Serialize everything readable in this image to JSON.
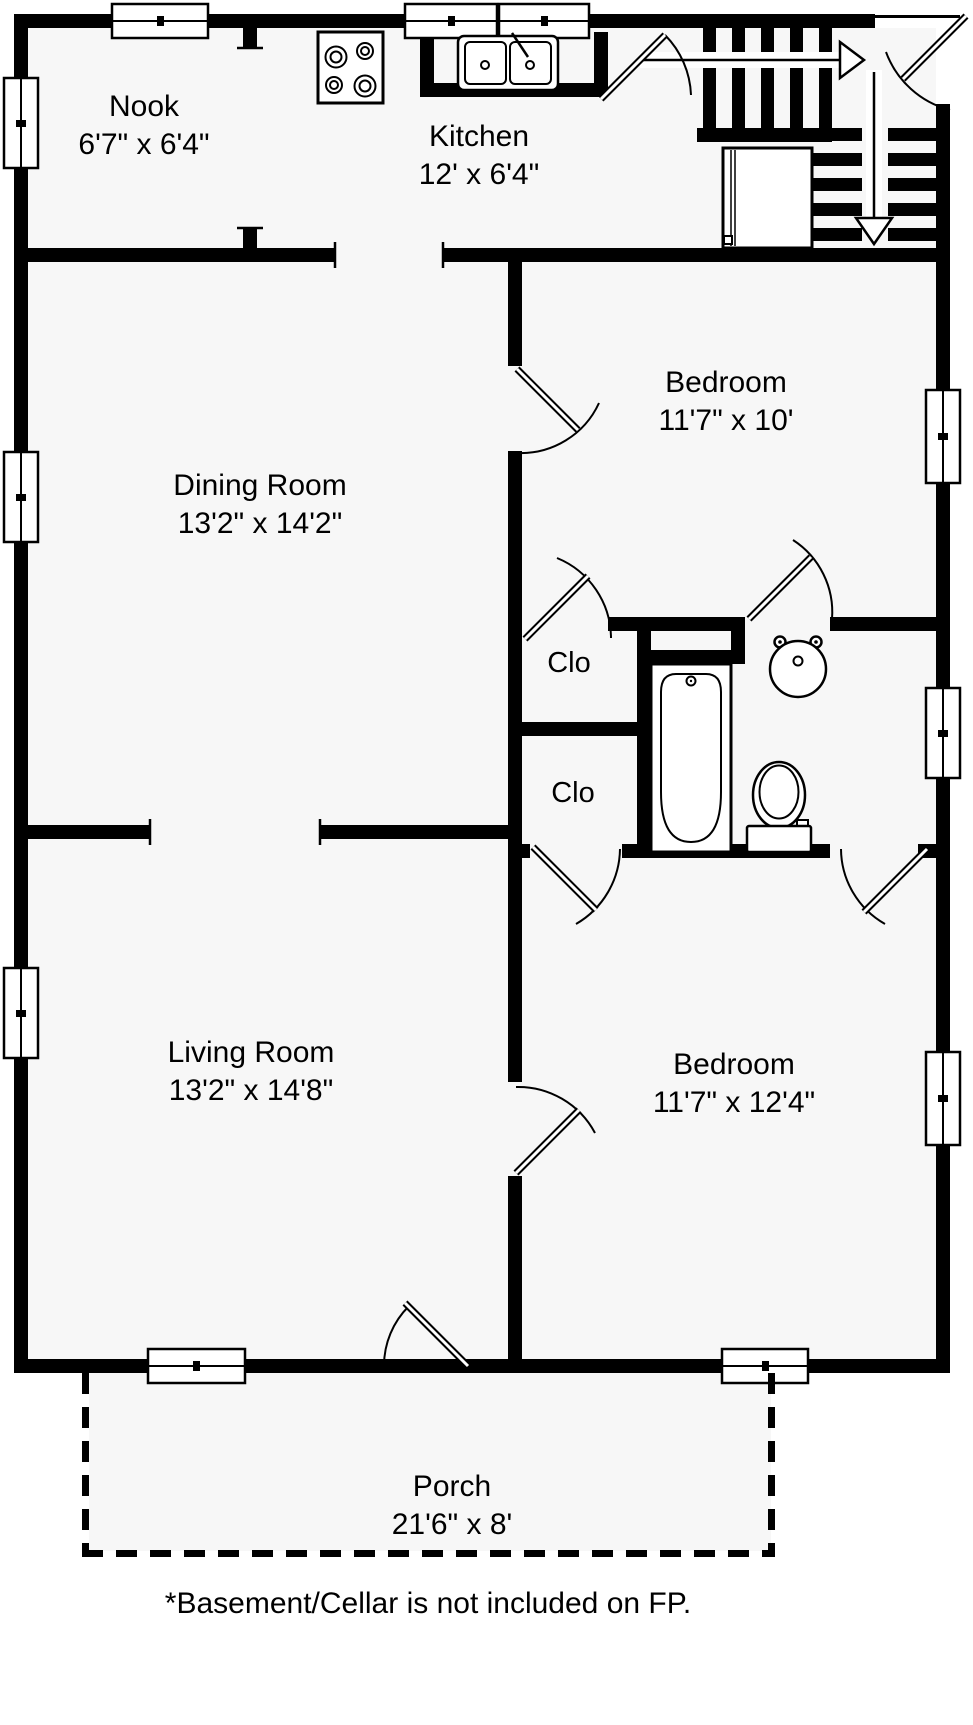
{
  "floorplan": {
    "rooms": [
      {
        "name": "Nook",
        "dims": "6'7\" x 6'4\""
      },
      {
        "name": "Kitchen",
        "dims": "12' x 6'4\""
      },
      {
        "name": "Dining Room",
        "dims": "13'2\" x 14'2\""
      },
      {
        "name": "Bedroom",
        "dims": "11'7\" x 10'"
      },
      {
        "name": "Living Room",
        "dims": "13'2\" x 14'8\""
      },
      {
        "name": "Bedroom",
        "dims": "11'7\" x 12'4\""
      },
      {
        "name": "Porch",
        "dims": "21'6\" x 8'"
      }
    ],
    "closets": [
      {
        "label": "Clo"
      },
      {
        "label": "Clo"
      }
    ],
    "footnote": "*Basement/Cellar is not included on FP.",
    "fixtures": [
      "stove",
      "kitchen-sink",
      "refrigerator",
      "stairs-up-arrow",
      "stairs-down-arrow",
      "bathtub",
      "pedestal-sink",
      "toilet",
      "door-swing",
      "window"
    ],
    "colors": {
      "wall": "#000000",
      "floor": "#f7f7f7",
      "background": "#ffffff"
    }
  }
}
